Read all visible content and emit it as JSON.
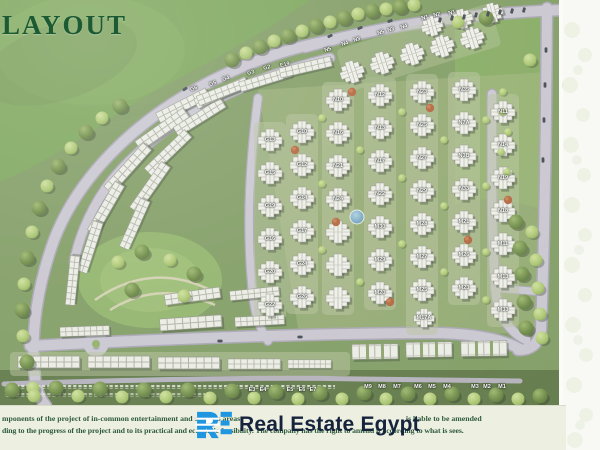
{
  "title": {
    "text": "LAYOUT",
    "color": "#1b5a33"
  },
  "watermark": {
    "logo_monogram": "RE",
    "brand": "Real Estate Egypt",
    "logo_color": "#2196e0",
    "text_color": "#15233d"
  },
  "footer": {
    "line1a": "mponents of the project of in-common entertainment and services areas",
    "line1b": ", is liable to be amended",
    "line2": "ding to the progress of the project and to its practical and economic feasibility. The company has the right to amend it according to what is sees."
  },
  "colors": {
    "grass": "#7e9a60",
    "lawn": "#7aa458",
    "road": "#c9c5d0",
    "road_edge": "#a7a3b2",
    "building": "#efefe9",
    "footer_bg": "#edefe1",
    "pond": "#6fa6c9"
  },
  "map": {
    "blocks": [
      {
        "code": "N5",
        "x": 328,
        "y": 50,
        "r": -18
      },
      {
        "code": "N4",
        "x": 345,
        "y": 44,
        "r": -18
      },
      {
        "code": "N3",
        "x": 357,
        "y": 40,
        "r": -18
      },
      {
        "code": "N5",
        "x": 381,
        "y": 33,
        "r": -18
      },
      {
        "code": "N3",
        "x": 391,
        "y": 30,
        "r": -18
      },
      {
        "code": "N4",
        "x": 404,
        "y": 27,
        "r": -18
      },
      {
        "code": "N1",
        "x": 425,
        "y": 18,
        "r": -16
      },
      {
        "code": "N2",
        "x": 437,
        "y": 15,
        "r": -16
      },
      {
        "code": "N1",
        "x": 452,
        "y": 13,
        "r": -16
      },
      {
        "code": "G6",
        "x": 194,
        "y": 89,
        "r": -20
      },
      {
        "code": "G5",
        "x": 213,
        "y": 84,
        "r": -20
      },
      {
        "code": "G4",
        "x": 226,
        "y": 79,
        "r": -18
      },
      {
        "code": "G3",
        "x": 251,
        "y": 73,
        "r": -16
      },
      {
        "code": "G2",
        "x": 267,
        "y": 68,
        "r": -15
      },
      {
        "code": "E19",
        "x": 285,
        "y": 65,
        "r": -14
      },
      {
        "code": "G13",
        "x": 270,
        "y": 140
      },
      {
        "code": "G15",
        "x": 270,
        "y": 173
      },
      {
        "code": "G19",
        "x": 270,
        "y": 206
      },
      {
        "code": "G16",
        "x": 270,
        "y": 239
      },
      {
        "code": "G20",
        "x": 270,
        "y": 272
      },
      {
        "code": "G22",
        "x": 270,
        "y": 305
      },
      {
        "code": "G10",
        "x": 302,
        "y": 132
      },
      {
        "code": "G12",
        "x": 302,
        "y": 165
      },
      {
        "code": "G14",
        "x": 302,
        "y": 198
      },
      {
        "code": "G17",
        "x": 302,
        "y": 231
      },
      {
        "code": "G24",
        "x": 302,
        "y": 264
      },
      {
        "code": "G26",
        "x": 302,
        "y": 297
      },
      {
        "code": "N10",
        "x": 338,
        "y": 100
      },
      {
        "code": "N16",
        "x": 338,
        "y": 133
      },
      {
        "code": "N21",
        "x": 338,
        "y": 166
      },
      {
        "code": "N24",
        "x": 338,
        "y": 199
      },
      {
        "code": "N12",
        "x": 380,
        "y": 95
      },
      {
        "code": "N13",
        "x": 380,
        "y": 128
      },
      {
        "code": "N17",
        "x": 380,
        "y": 161
      },
      {
        "code": "N22",
        "x": 380,
        "y": 194
      },
      {
        "code": "N23",
        "x": 422,
        "y": 92
      },
      {
        "code": "N25",
        "x": 422,
        "y": 125
      },
      {
        "code": "N27",
        "x": 422,
        "y": 158
      },
      {
        "code": "N29",
        "x": 422,
        "y": 191
      },
      {
        "code": "N35",
        "x": 464,
        "y": 90
      },
      {
        "code": "N7A",
        "x": 464,
        "y": 123
      },
      {
        "code": "N3B",
        "x": 464,
        "y": 156
      },
      {
        "code": "N33",
        "x": 464,
        "y": 189
      },
      {
        "code": "N11",
        "x": 503,
        "y": 112
      },
      {
        "code": "N14",
        "x": 503,
        "y": 145
      },
      {
        "code": "N19",
        "x": 503,
        "y": 178
      },
      {
        "code": "N18",
        "x": 503,
        "y": 211
      },
      {
        "code": "M30",
        "x": 380,
        "y": 227
      },
      {
        "code": "M29",
        "x": 380,
        "y": 260
      },
      {
        "code": "M20",
        "x": 380,
        "y": 293
      },
      {
        "code": "M28",
        "x": 422,
        "y": 224
      },
      {
        "code": "M27",
        "x": 422,
        "y": 257
      },
      {
        "code": "M25",
        "x": 422,
        "y": 290
      },
      {
        "code": "M17A",
        "x": 424,
        "y": 318
      },
      {
        "code": "M21",
        "x": 464,
        "y": 222
      },
      {
        "code": "M26",
        "x": 464,
        "y": 255
      },
      {
        "code": "M23",
        "x": 464,
        "y": 288
      },
      {
        "code": "M11",
        "x": 503,
        "y": 244
      },
      {
        "code": "M13",
        "x": 503,
        "y": 277
      },
      {
        "code": "M33",
        "x": 503,
        "y": 310
      },
      {
        "code": "M9",
        "x": 368,
        "y": 387
      },
      {
        "code": "M8",
        "x": 382,
        "y": 387
      },
      {
        "code": "M7",
        "x": 397,
        "y": 387
      },
      {
        "code": "M6",
        "x": 418,
        "y": 387
      },
      {
        "code": "M5",
        "x": 432,
        "y": 387
      },
      {
        "code": "M4",
        "x": 447,
        "y": 387
      },
      {
        "code": "M3",
        "x": 475,
        "y": 387
      },
      {
        "code": "M2",
        "x": 487,
        "y": 387
      },
      {
        "code": "M1",
        "x": 502,
        "y": 387
      },
      {
        "code": "E3",
        "x": 252,
        "y": 390
      },
      {
        "code": "E4",
        "x": 263,
        "y": 390
      },
      {
        "code": "E5",
        "x": 290,
        "y": 390
      },
      {
        "code": "E6",
        "x": 302,
        "y": 390
      },
      {
        "code": "E7",
        "x": 313,
        "y": 390
      }
    ]
  }
}
